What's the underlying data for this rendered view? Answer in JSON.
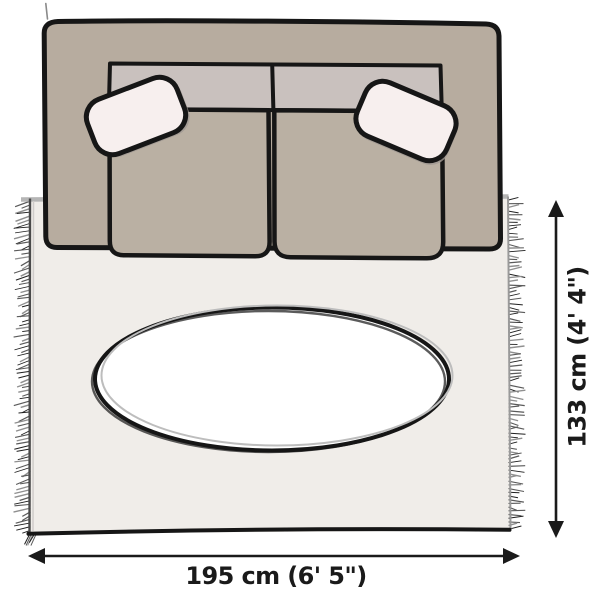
{
  "scene": {
    "view": "top-down-illustration",
    "objects": [
      "two-seat-sofa",
      "throw-pillow-left",
      "throw-pillow-right",
      "fringed-area-rug",
      "oval-rug-center"
    ]
  },
  "dimensions": {
    "width": {
      "label": "195 cm (6' 5\")",
      "cm": 195,
      "imperial": "6' 5\""
    },
    "height": {
      "label": "133 cm (4' 4\")",
      "cm": 133,
      "imperial": "4' 4\""
    }
  },
  "colors": {
    "background": "#ffffff",
    "outline": "#161616",
    "sofa_body": "#b7ac9f",
    "sofa_backrest": "#c9c1be",
    "seat_cushion": "#bab0a3",
    "pillow": "#f7efee",
    "pillow_shadow": "#a09892",
    "rug": "#f0ede9",
    "rug_edge_top": "#b5b5b5",
    "rug_edge_mid": "#999999",
    "rug_edge_dark": "#4a4a4a",
    "rug_edge_light": "#cfccca",
    "oval_fill": "#ffffff",
    "oval_stroke_light": "#bdbdbd",
    "sketch_stray": "#8a8a8a",
    "dimension": "#1a1a1a",
    "fringe": [
      "#1f1f1f",
      "#5a5a5a",
      "#8f8f8f"
    ]
  }
}
